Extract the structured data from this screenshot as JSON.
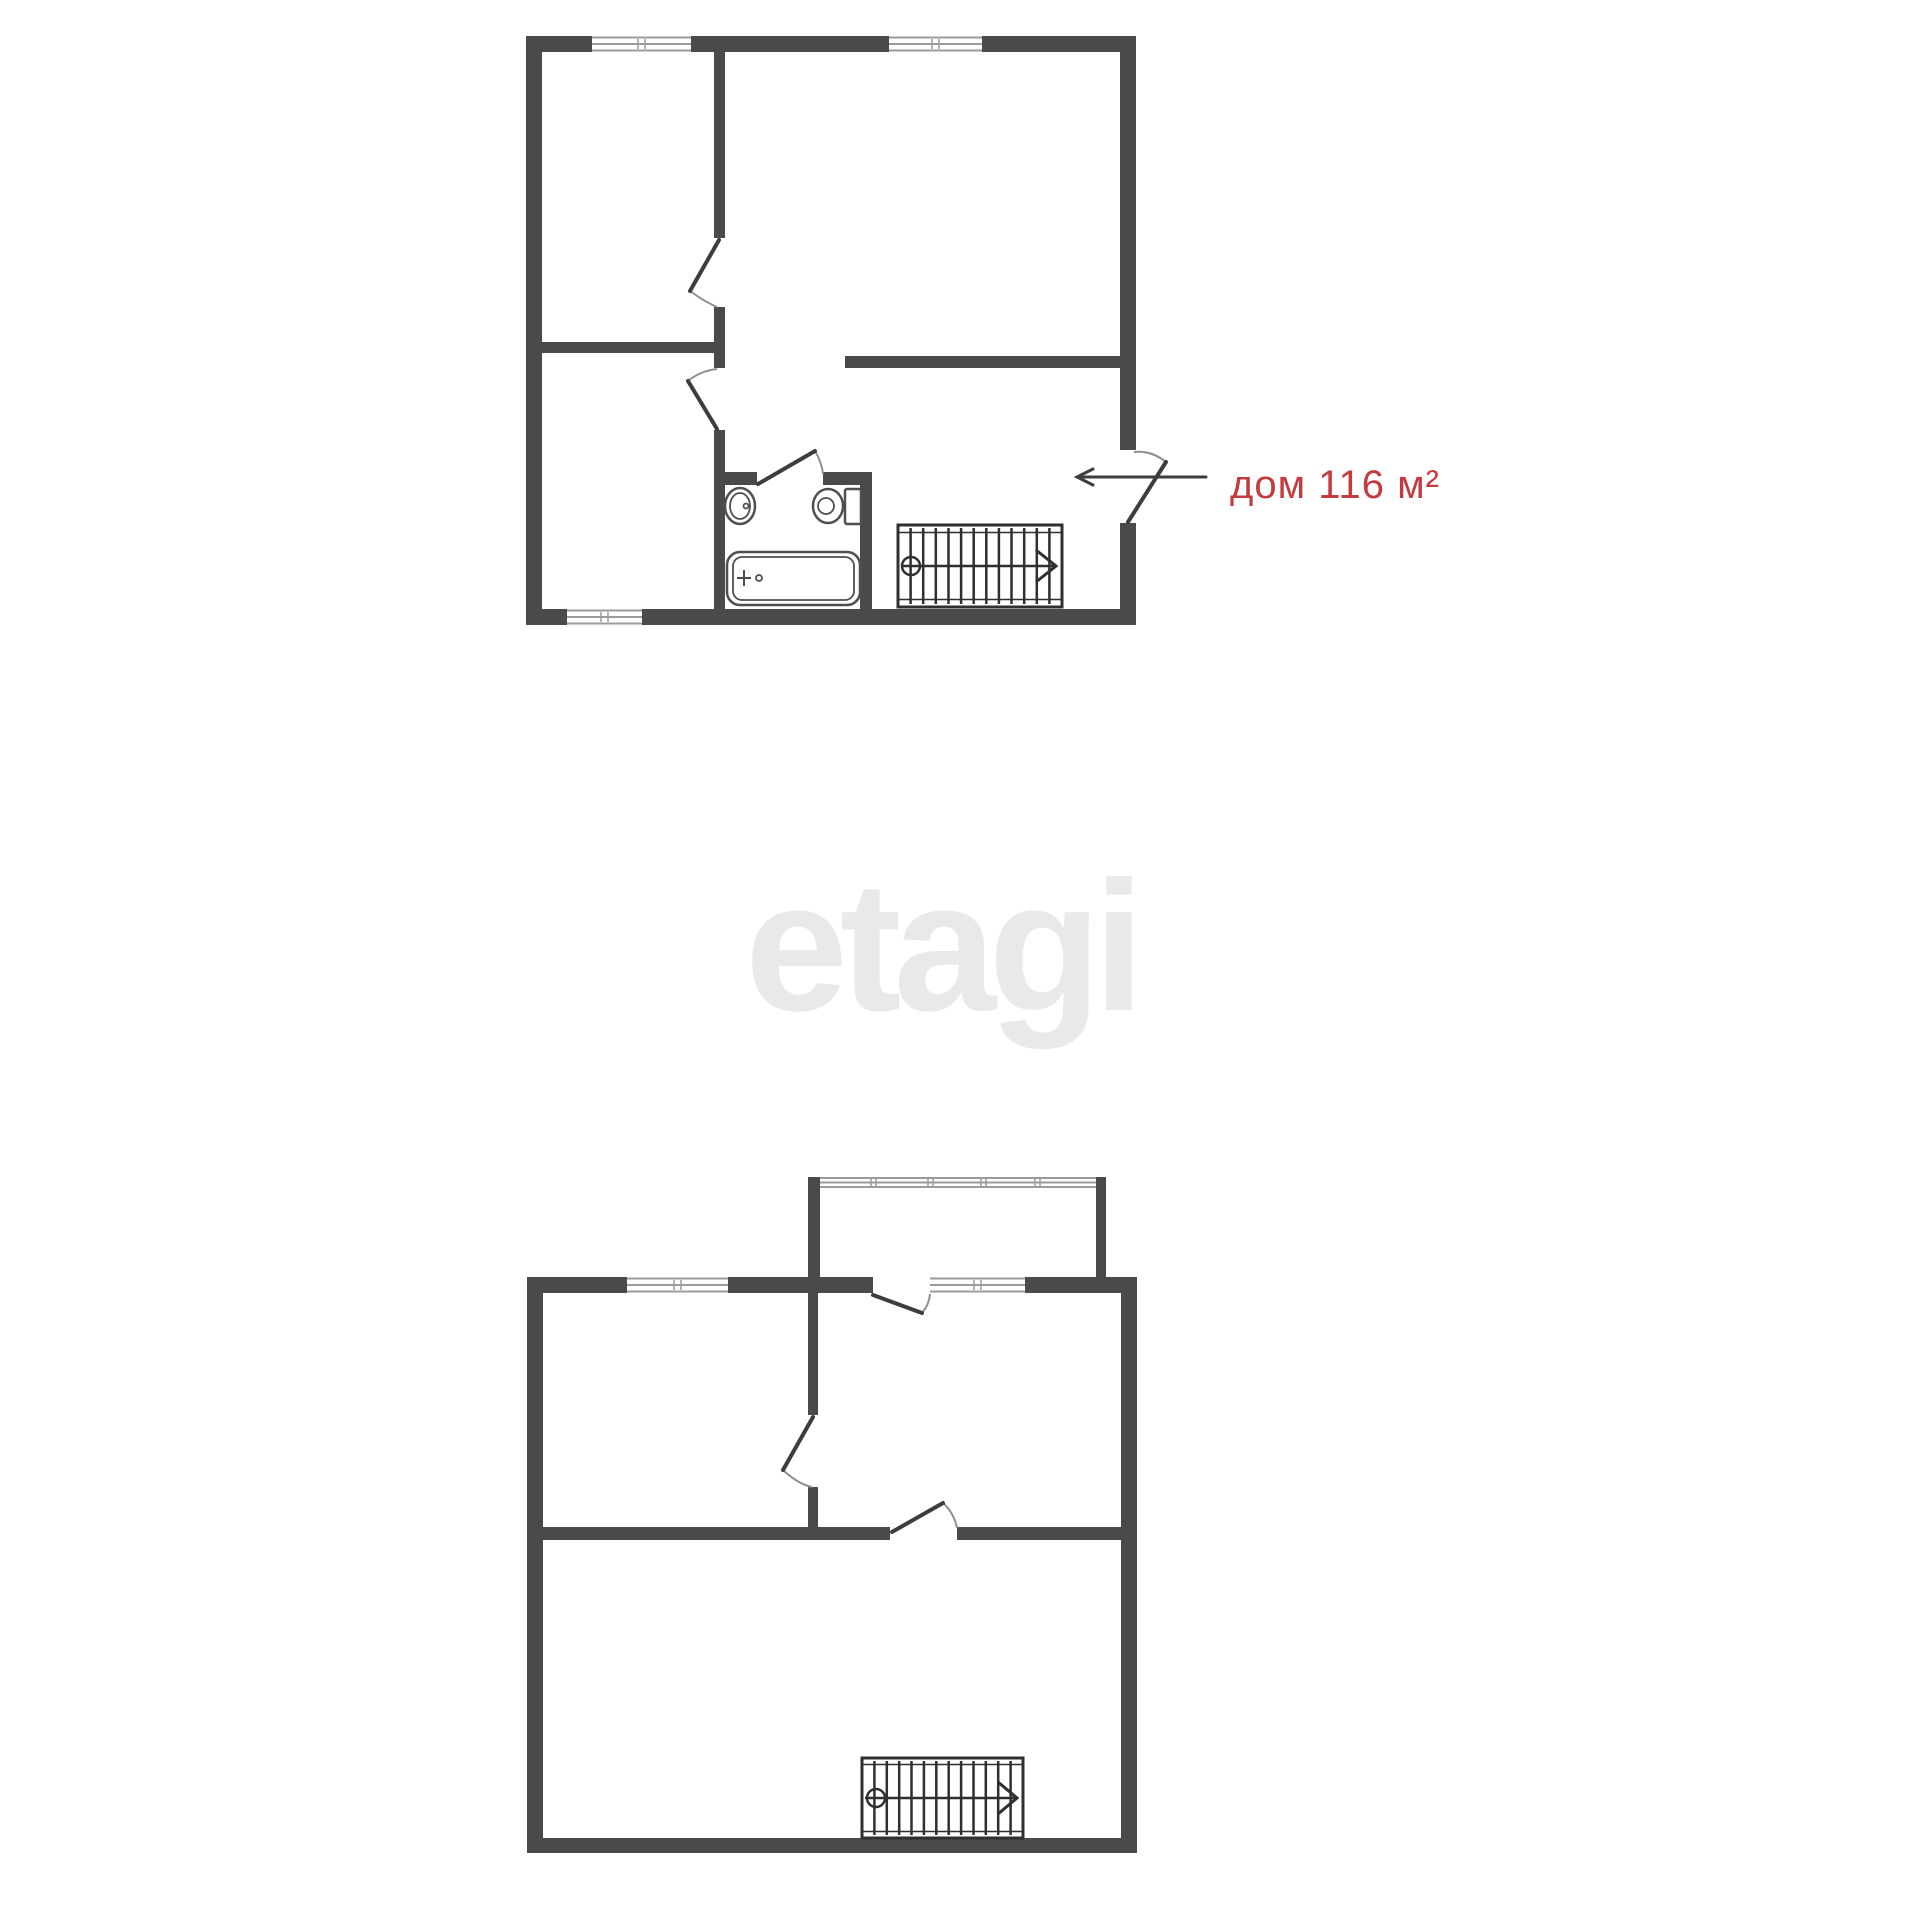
{
  "watermark": {
    "text": "etagi",
    "color": "#e9e9e9"
  },
  "area_label": {
    "text": "дом 116 м²",
    "color": "#c33b3c"
  },
  "colors": {
    "background": "#ffffff",
    "wall": "#4a4a4a",
    "door_line": "#3d3d3d",
    "door_arc": "#8f8f8f",
    "window_line": "#9b9b9b",
    "fixture_line": "#4f4f4f",
    "stair_line": "#2f2f2f"
  }
}
